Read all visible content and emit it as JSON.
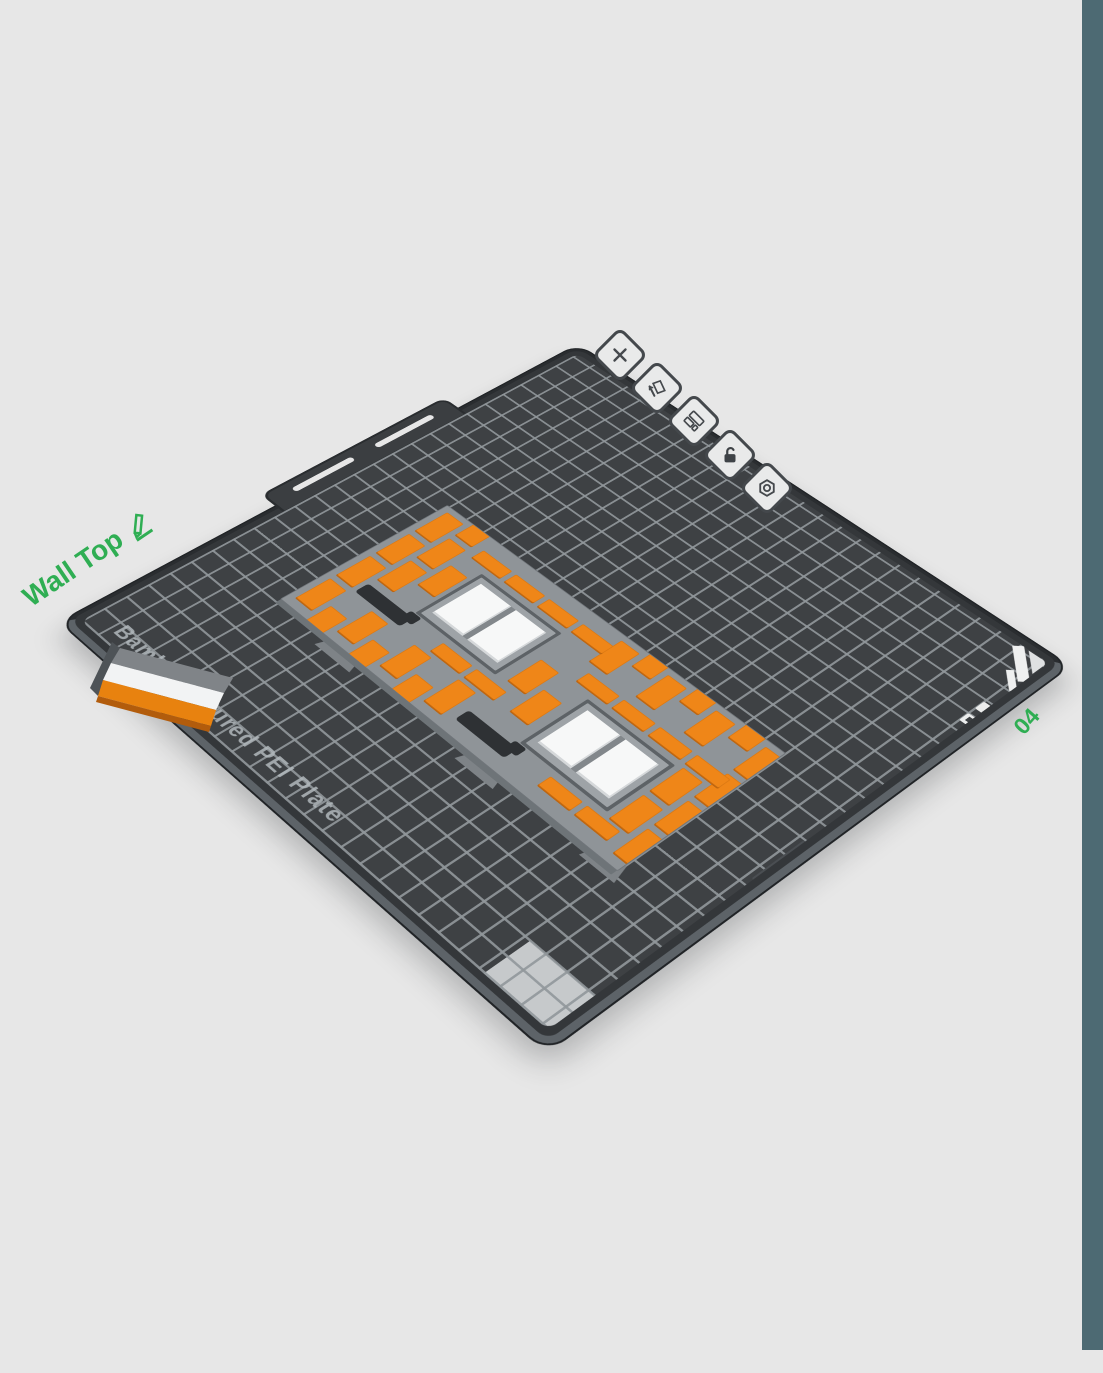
{
  "app": {
    "background": "#e7e7e7",
    "accent_green": "#2fae53",
    "side_stripe_color": "#4d6a73"
  },
  "object_label": {
    "text": "Wall Top",
    "icon": "pencil-icon"
  },
  "plate": {
    "number": "04",
    "name": "Bambu Textured PEI Plate",
    "surface_color": "#3e4144",
    "grid_line_color": "#91979b",
    "edge_text": "PEI (HB) · 28 T13",
    "toolbar_icons": [
      {
        "name": "delete-plate-icon"
      },
      {
        "name": "clean-plate-icon"
      },
      {
        "name": "rename-plate-icon"
      },
      {
        "name": "lock-plate-icon"
      },
      {
        "name": "plate-settings-icon"
      }
    ]
  },
  "model": {
    "description": "Brick wall panel with two double-pane windows",
    "brick_color": "#ef8618",
    "mortar_color": "#8f9498",
    "frame_color": "#9ea3a7",
    "pane_color": "#f7f8f8",
    "window_count": 2
  },
  "wall_top_piece": {
    "top_color": "#f2f3f4",
    "back_color": "#808488",
    "front_color": "#e8820f",
    "lip_color": "#b25c0c"
  }
}
